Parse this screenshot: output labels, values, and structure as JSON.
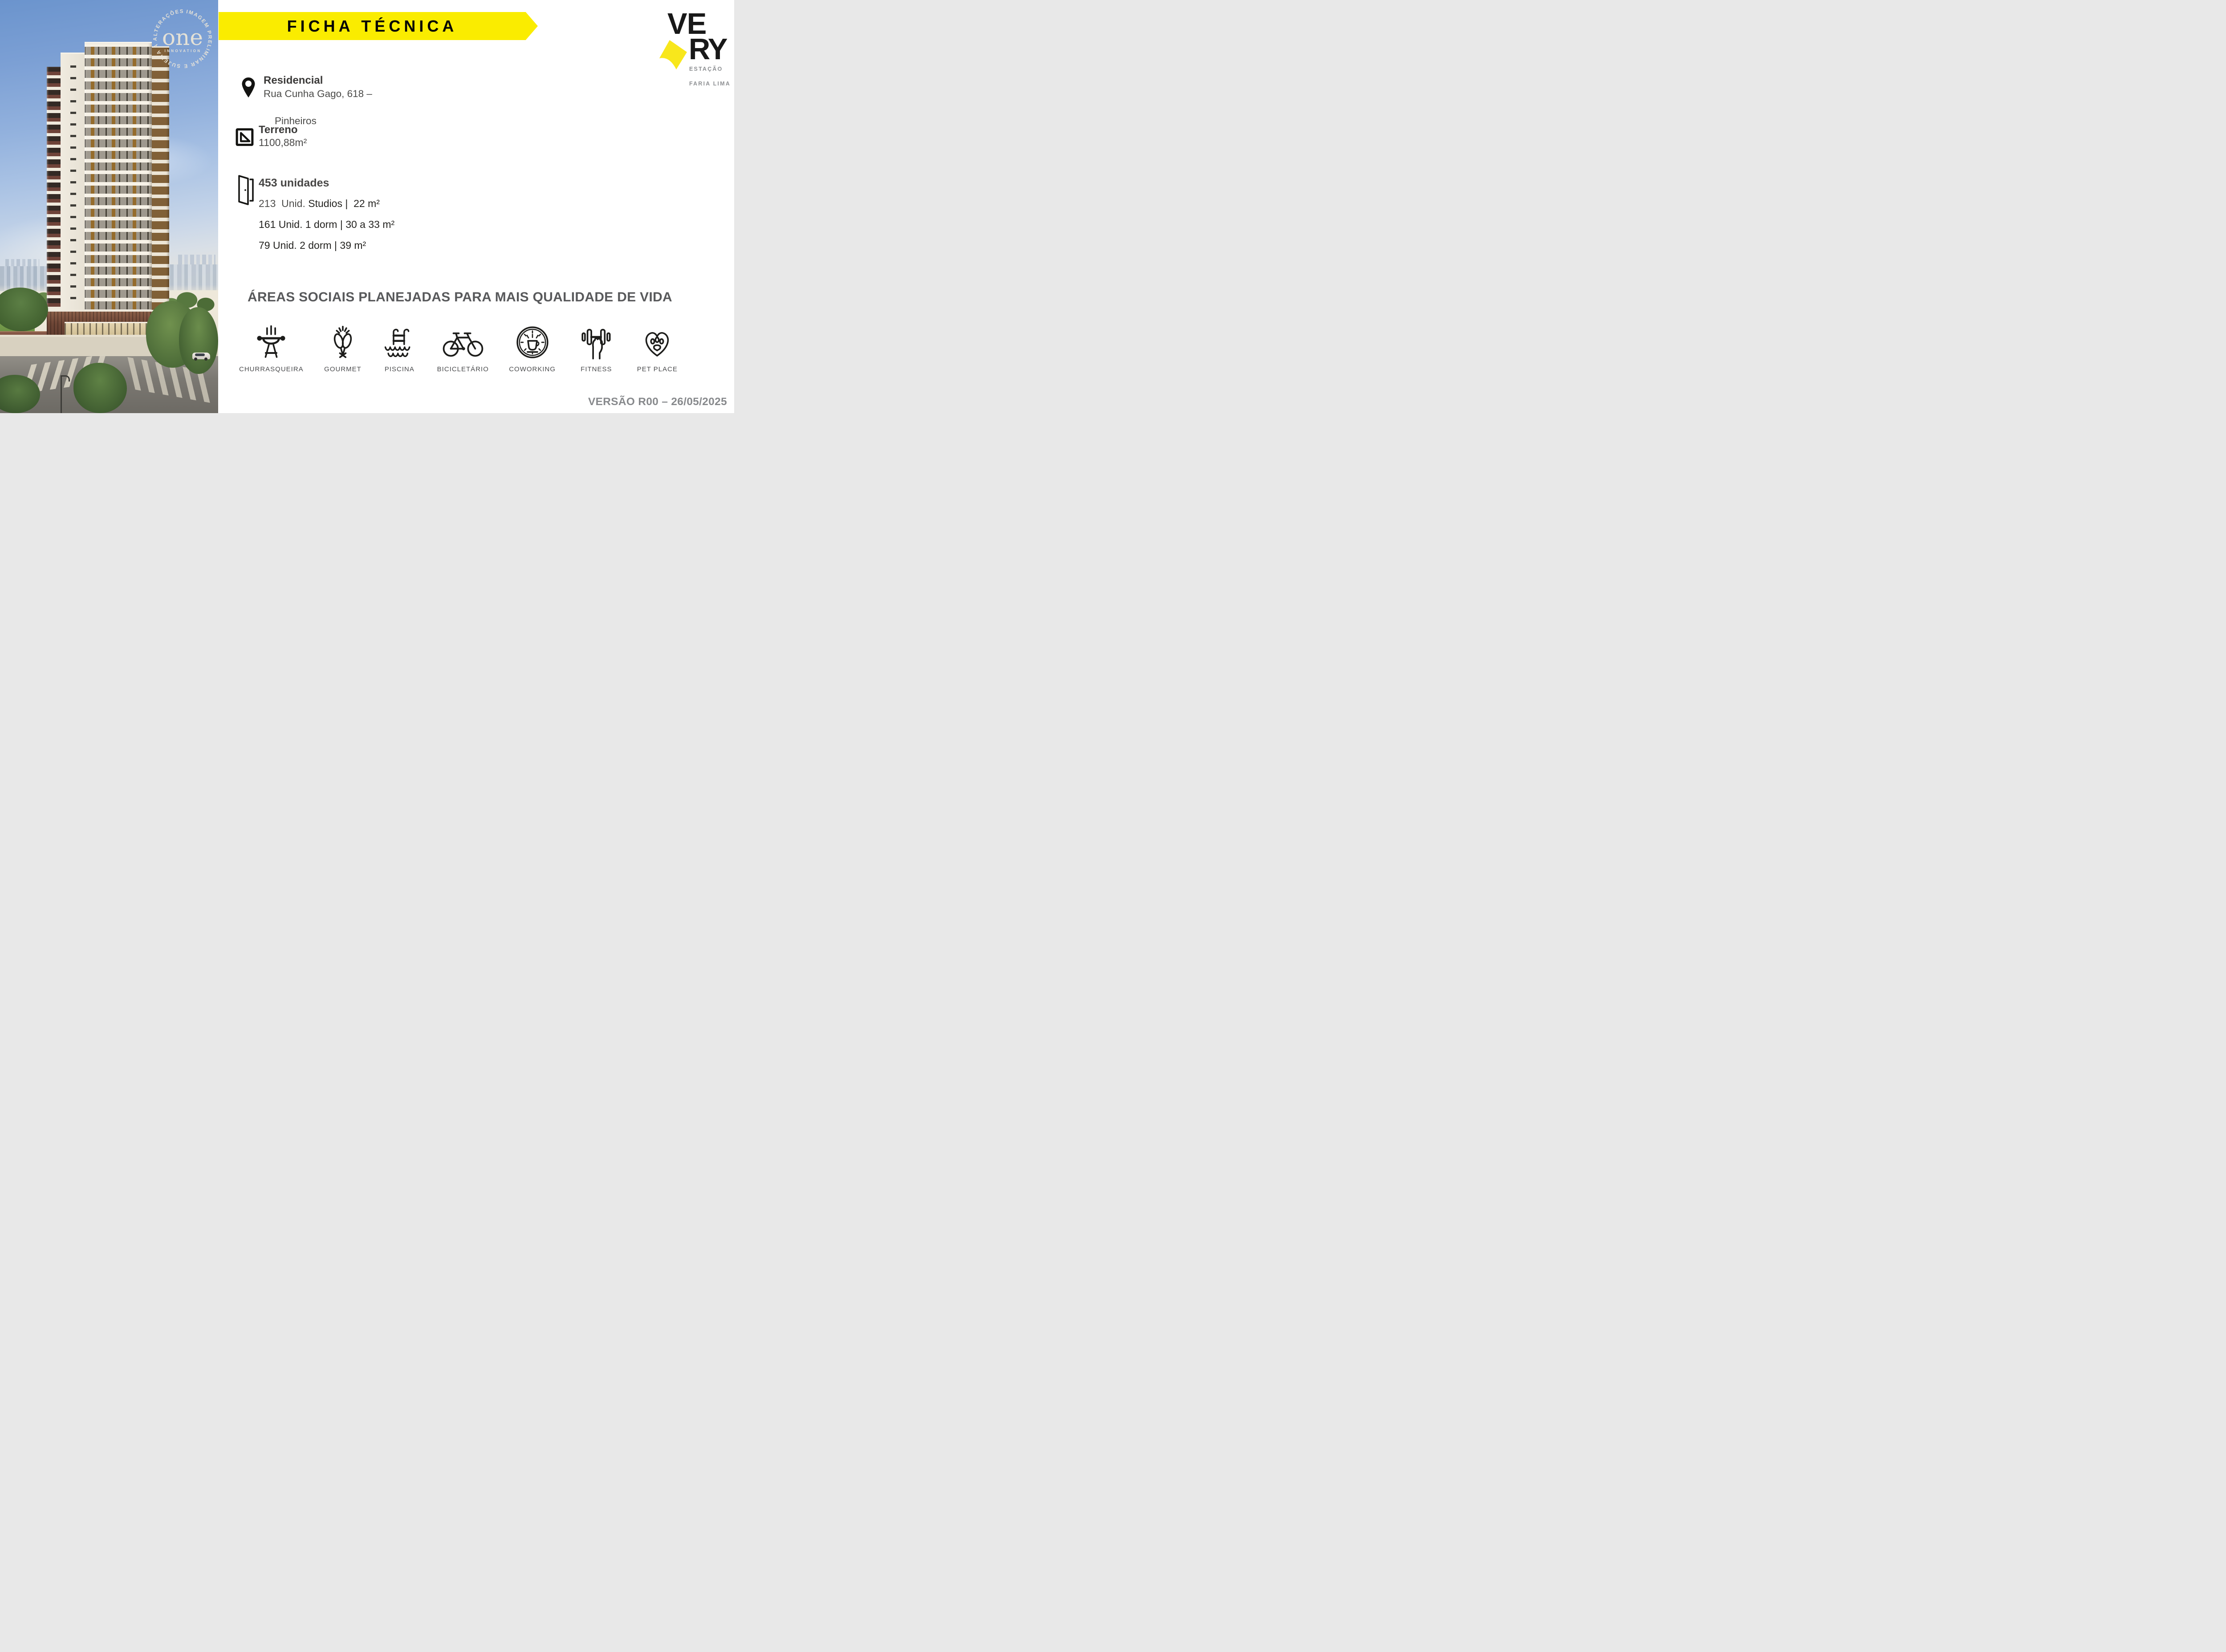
{
  "banner": {
    "title": "FICHA TÉCNICA",
    "background": "#FAEC00"
  },
  "brand": {
    "word_top": "VE",
    "word_bottom": "RY",
    "subtitle_line1": "ESTAÇÃO",
    "subtitle_line2": "FARIA LIMA",
    "arrow_color": "#F8E71C"
  },
  "watermark": {
    "ring_text": "IMAGEM PRELIMINAR E SUJEITA A ALTERAÇÕES.",
    "logo_word": "one",
    "logo_sub": "INNOVATION"
  },
  "info": {
    "residential": {
      "title": "Residencial",
      "address_line1": "Rua Cunha Gago, 618 –",
      "address_line2": "Pinheiros"
    },
    "terrain": {
      "title": "Terreno",
      "area": "1100,88m²"
    },
    "units": {
      "total": "453 unidades",
      "lines": [
        {
          "qty": "213  Unid.",
          "desc": "Studios |  22 m²"
        },
        {
          "qty": "161 Unid.",
          "desc": "1 dorm | 30 a 33 m²"
        },
        {
          "qty": "79 Unid.",
          "desc": "2 dorm | 39 m²"
        }
      ]
    }
  },
  "amenities": {
    "heading": "ÁREAS SOCIAIS PLANEJADAS PARA MAIS QUALIDADE DE VIDA",
    "items": [
      {
        "icon": "grill-icon",
        "label": "CHURRASQUEIRA"
      },
      {
        "icon": "toast-glasses-icon",
        "label": "GOURMET"
      },
      {
        "icon": "pool-ladder-icon",
        "label": "PISCINA"
      },
      {
        "icon": "bicycle-icon",
        "label": "BICICLETÁRIO"
      },
      {
        "icon": "clock-coffee-icon",
        "label": "COWORKING"
      },
      {
        "icon": "dumbbell-hand-icon",
        "label": "FITNESS"
      },
      {
        "icon": "heart-paw-icon",
        "label": "PET PLACE"
      }
    ]
  },
  "footer": {
    "version": "VERSÃO R00 – 26/05/2025"
  },
  "colors": {
    "banner_yellow": "#FAEC00",
    "logo_yellow": "#F8E71C",
    "text_dark": "#242320",
    "text_gray": "#58595b",
    "version_gray": "#87898c"
  }
}
